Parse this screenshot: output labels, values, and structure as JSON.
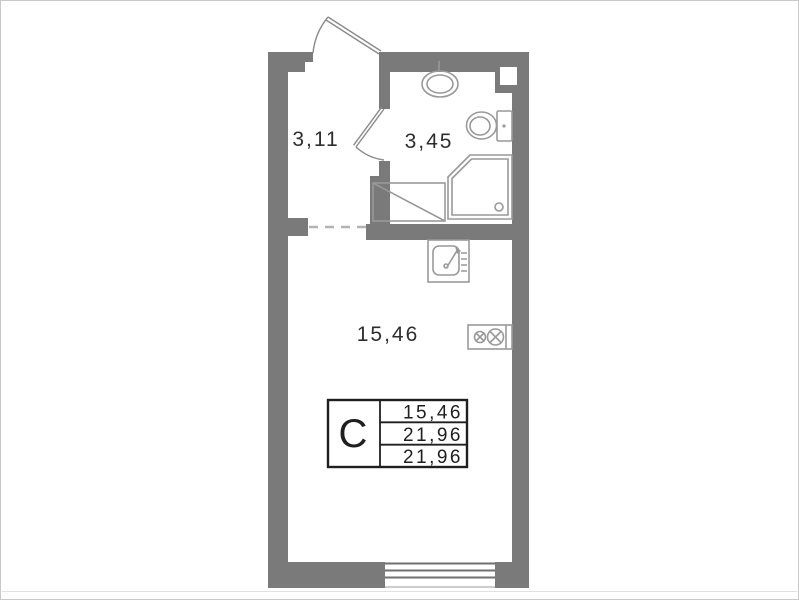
{
  "colors": {
    "wall": "#7a7a7a",
    "fixture": "#999999",
    "door": "#8b8b8b",
    "label": "#2e2e2e",
    "stamp_border": "#1f1f1f",
    "stamp_text": "#1f1f1f",
    "dash": "#b3b3b3",
    "window_line": "#6f6f6f",
    "background": "#ffffff",
    "frame": "#c9c9c9",
    "image_edge": "#e0e0e0"
  },
  "plan": {
    "title": "Studio apartment floor plan",
    "rooms": [
      {
        "name": "hallway",
        "area": "3,11"
      },
      {
        "name": "bathroom",
        "area": "3,45"
      },
      {
        "name": "living-room",
        "area": "15,46"
      }
    ],
    "stamp": {
      "type_label": "С",
      "values": [
        "15,46",
        "21,96",
        "21,96"
      ]
    },
    "fixtures": [
      "entrance-door",
      "bathroom-door",
      "wash-basin",
      "toilet",
      "shower",
      "washing-machine",
      "kitchen-sink",
      "stove",
      "window",
      "vent-duct"
    ]
  }
}
